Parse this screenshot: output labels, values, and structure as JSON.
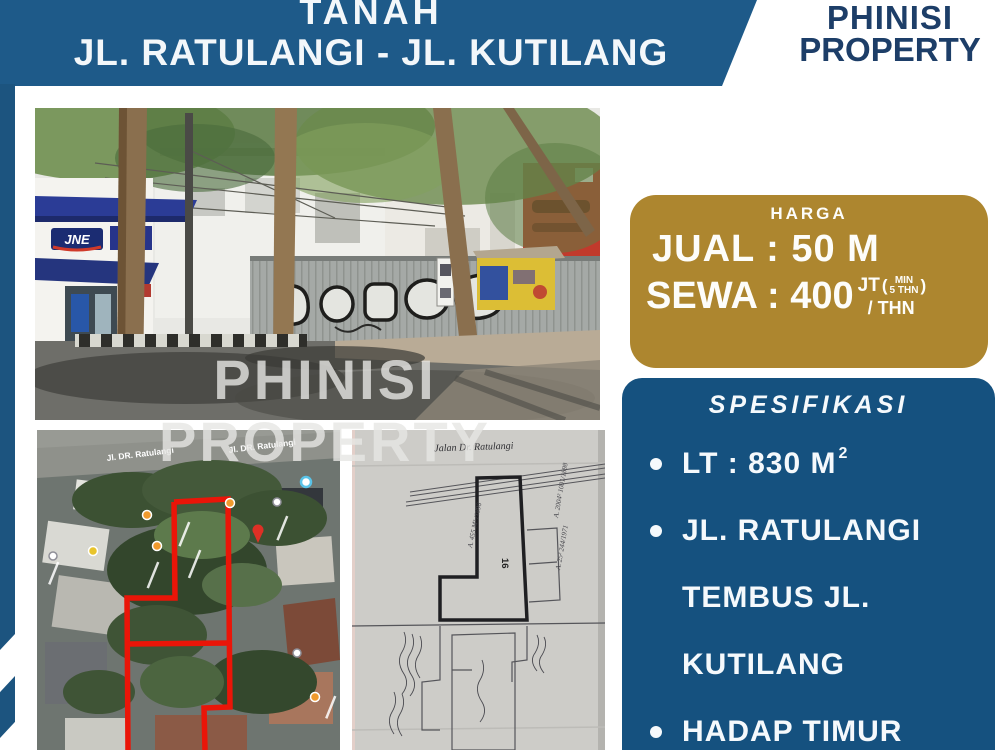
{
  "colors": {
    "banner_blue": "#1e5a89",
    "panel_blue": "#15517f",
    "logo_navy": "#1d3e68",
    "badge_gold": "#ad862f",
    "parcel_red": "#ea1508"
  },
  "banner": {
    "line1": "TANAH",
    "line2": "JL. RATULANGI - JL. KUTILANG"
  },
  "logo": {
    "line1": "PHINISI",
    "line2": "PROPERTY"
  },
  "watermark": {
    "line1": "PHINISI",
    "line2": "PROPERTY"
  },
  "photo": {
    "shop_sign": "JNE"
  },
  "map": {
    "road_label_1": "Jl. DR. Ratulangi",
    "road_label_2": "Jl. DR. Ratulangi"
  },
  "certificate": {
    "road_script": "Jalan Dr. Ratulangi",
    "parcel_number": "16",
    "annotation_1": "A. 455 M² /1896",
    "annotation_2": "A. 2004² 1001/1898",
    "annotation_3": "A. 25² 244/1971"
  },
  "price": {
    "header": "HARGA",
    "jual": "JUAL : 50 M",
    "sewa": "SEWA : 400",
    "unit": "JT",
    "paren_open": "(",
    "min_top": "MIN",
    "min_bottom": "5 THN",
    "paren_close": ")",
    "per_year": "/ THN"
  },
  "spec": {
    "heading": "SPESIFIKASI",
    "items": [
      {
        "bullet": "true",
        "text": "LT : 830 M",
        "sup": "2"
      },
      {
        "bullet": "true",
        "text": "JL. RATULANGI"
      },
      {
        "bullet": "false",
        "text": "TEMBUS JL."
      },
      {
        "bullet": "false",
        "text": "KUTILANG"
      },
      {
        "bullet": "true",
        "text": "HADAP TIMUR"
      }
    ]
  }
}
